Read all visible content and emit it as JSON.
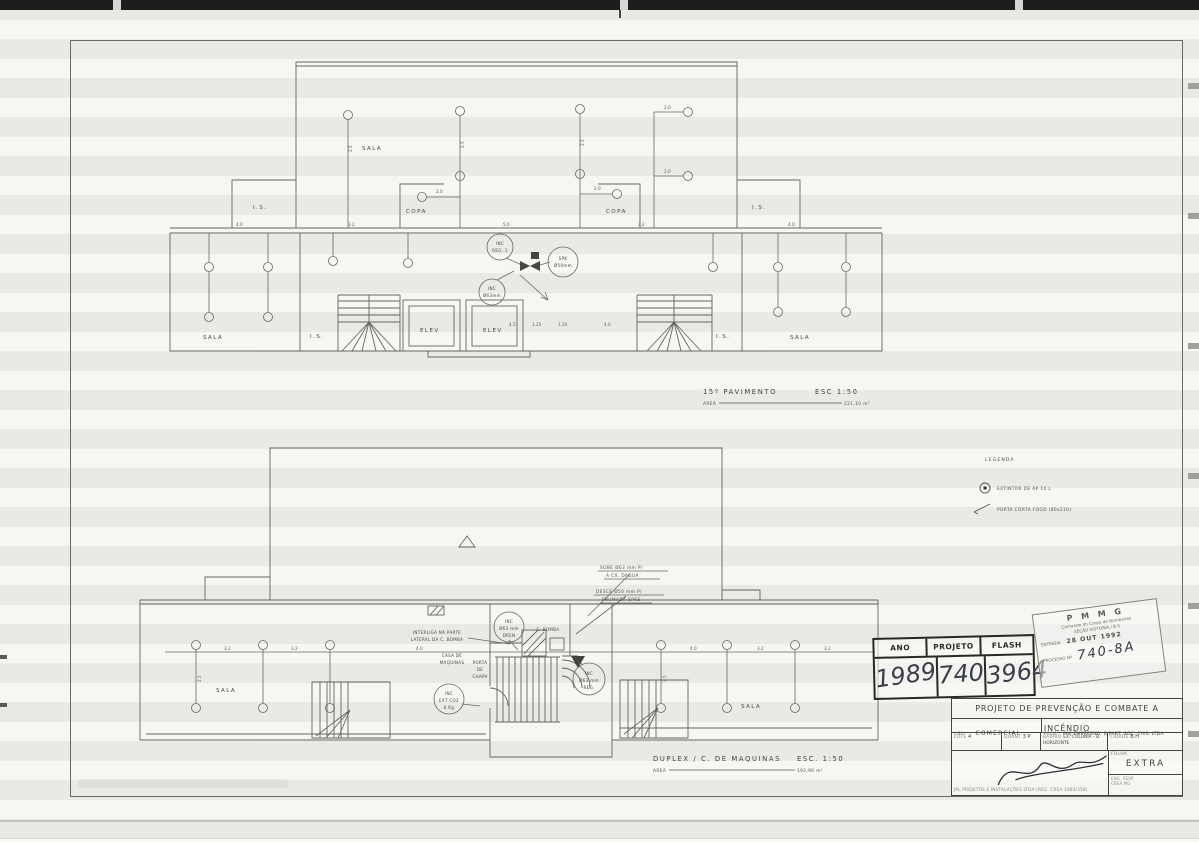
{
  "upper": {
    "sala_top": "SALA",
    "is_lt": "I.S.",
    "copa_l": "COPA",
    "copa_r": "COPA",
    "is_rt": "I.S.",
    "sala_bl": "SALA",
    "is_bl": "I.S.",
    "elev1": "ELEV",
    "elev2": "ELEV",
    "is_br": "I.S.",
    "sala_br": "SALA",
    "c1a": "INC",
    "c1b": "REG. 1",
    "c2a": "SPK",
    "c2b": "Ø50mm",
    "c3a": "INC",
    "c3b": "Ø63mm",
    "title": "15º PAVIMENTO",
    "esc": "ESC   1:50",
    "area_label": "AREA",
    "area": "221,10 m²",
    "dims": {
      "d20": "2.0",
      "d25": "2.5",
      "d40": "4.0",
      "d32": "3.2",
      "d50": "5.0",
      "d45": "4.5",
      "d125": "1.25",
      "d120": "1.20"
    }
  },
  "lower": {
    "sala_l": "SALA",
    "sala_r": "SALA",
    "casa1": "CASA DE",
    "casa2": "MAQUINAS",
    "porta1": "PORTA",
    "porta2": "DE",
    "porta3": "CHAPA",
    "bomba": "C. BOMBA",
    "sobe1": "SOBE Ø63 mm P/",
    "sobe2": "A CX. DAGUA",
    "desce1": "DESCE Ø50 mm P/",
    "desce2": "PRUMADA SPKS",
    "inter1": "INTERLIGA NA PARTE",
    "inter2": "LATERAL DA C. BOMBA",
    "c1a": "INC",
    "c1b": "Ø63 mm",
    "c1c": "DREN",
    "c2a": "INC",
    "c2b": "Ø63 mm",
    "c2c": "REG.",
    "c3a": "INC",
    "c3b": "EXT CO2",
    "c3c": "6 Kg",
    "title": "DUPLEX / C. DE MAQUINAS",
    "esc": "ESC.  1:50",
    "area_label": "AREA",
    "area": "192,90 m²",
    "dims": {
      "d32": "3.2",
      "d40": "4.0",
      "d25": "2.5"
    }
  },
  "legend": {
    "title": "LEGENDA",
    "extintor": "EXTINTOR DE AP 10 L",
    "porta": "PORTA CORTA FOGO (80x210)"
  },
  "ano_stamp": {
    "h1": "ANO",
    "h2": "PROJETO",
    "h3": "FLASH",
    "v1": "1989",
    "v2": "740",
    "v3": "3964"
  },
  "pmmg": {
    "l1": "P M M G",
    "l2": "Comando do Corpo de Bombeiros",
    "l3": "SEÇÃO VISTORIA / B-5",
    "entrada": "ENTRADA",
    "date": "28 OUT 1992",
    "proc": "PROCESSO Nº",
    "num": "740-8A"
  },
  "tb": {
    "title": "PROJETO DE PREVENÇÃO E COMBATE A INCÊNDIO",
    "uso_label": "USO",
    "uso": "COMERCIAL",
    "prop_label": "PROP.",
    "prop": "PMJ EMPREEND. E PART. SOC. CIVIL LTDA",
    "lote_label": "LOTE",
    "lote": "4",
    "quant_label": "QUANT",
    "quant": "3 P",
    "bairro_label": "BAIRRO",
    "bairro": "EX. COLONIA - B. HORIZONTE",
    "cidade_label": "CIDADE",
    "cidade": "B.H",
    "folha_label": "FOLHA",
    "folha": "EXTRA",
    "firm": "JPL PROJETOS E INSTALAÇÕES LTDA  (REG. CREA 1984/358)",
    "resp1": "ENG. RESP.",
    "resp2": "CREA MG"
  }
}
